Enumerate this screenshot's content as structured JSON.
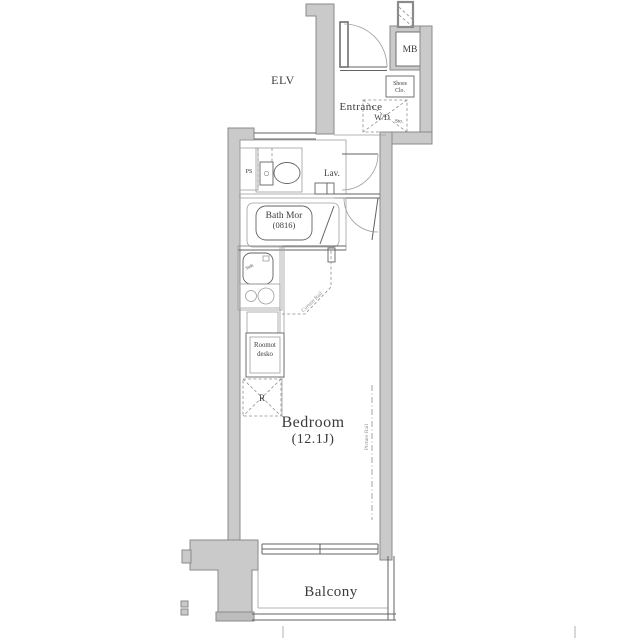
{
  "floorplan": {
    "common": {
      "elevator": "ELV",
      "meter_box": "MB"
    },
    "entrance": {
      "label": "Entrance",
      "shoes_closet_line1": "Shoes",
      "shoes_closet_line2": "Clo.",
      "washer_dryer": "W/D",
      "washer_dryer_sub": "Sto."
    },
    "sanitary": {
      "pipe_space": "PS",
      "lavatory": "Lav.",
      "bath_line1": "Bath Mor",
      "bath_line2": "(0816)"
    },
    "kitchen": {
      "sink": "Sink",
      "storage_line1": "Roomot",
      "storage_line2": "desko",
      "refrigerator": "R"
    },
    "bedroom": {
      "name": "Bedroom",
      "size": "(12.1J)",
      "curtain_rail": "Curtain Rail",
      "picture_rail": "Picture Rail"
    },
    "balcony": {
      "label": "Balcony"
    },
    "colors": {
      "wall_fill": "#cacaca",
      "wall_stroke": "#8a8a8a",
      "line": "#636363",
      "light_line": "#9e9e9e",
      "dash": "#8f8f8f",
      "text": "#3b3b3b",
      "background": "#ffffff"
    }
  }
}
